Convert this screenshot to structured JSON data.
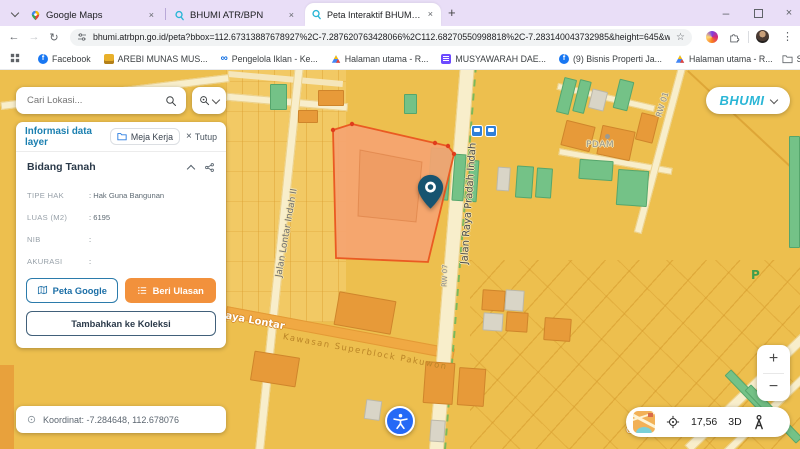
{
  "browser": {
    "tabs": [
      {
        "label": "Google Maps"
      },
      {
        "label": "BHUMI ATR/BPN"
      },
      {
        "label": "Peta Interaktif BHUMI ATR/BPN"
      }
    ],
    "url": "bhumi.atrbpn.go.id/peta?bbox=112.67313887678927%2C-7.287620763428066%2C112.68270550998818%2C-7.283140043732985&height=645&width=1366...",
    "bookmarks": {
      "items": [
        {
          "label": "Facebook"
        },
        {
          "label": "AREBI MUNAS MUS..."
        },
        {
          "label": "Pengelola Iklan - Ke..."
        },
        {
          "label": "Halaman utama - R..."
        },
        {
          "label": "MUSYAWARAH DAE..."
        },
        {
          "label": "(9) Bisnis Properti Ja..."
        },
        {
          "label": "Halaman utama - R..."
        }
      ],
      "all_label": "Semua Bookmark"
    }
  },
  "icons": {
    "back": "←",
    "forward": "→",
    "reload": "↻",
    "star": "☆",
    "kebab": "⋮",
    "new_tab": "+",
    "minimize": "–",
    "close": "×",
    "zoom_in": "+",
    "zoom_out": "−"
  },
  "map_ui": {
    "search_placeholder": "Cari Lokasi...",
    "brand": "BHUMI",
    "coordinate_bar": "Koordinat: -7.284648, 112.678076",
    "controls": {
      "zoom_level": "17,56",
      "mode_3d": "3D"
    }
  },
  "panel": {
    "title": "Informasi data layer",
    "meja_kerja": "Meja Kerja",
    "tutup": "Tutup",
    "section_title": "Bidang Tanah",
    "fields": [
      {
        "label": "TIPE HAK",
        "value": ": Hak Guna Bangunan"
      },
      {
        "label": "LUAS (M2)",
        "value": ": 6195"
      },
      {
        "label": "NIB",
        "value": ":"
      },
      {
        "label": "AKURASI",
        "value": ":"
      }
    ],
    "actions": {
      "peta_google": "Peta Google",
      "beri_ulasan": "Beri Ulasan",
      "tambah_koleksi": "Tambahkan ke Koleksi"
    }
  },
  "map": {
    "labels": {
      "street_lontar_indah": "Jalan Lontar Indah II",
      "street_pradah_indah": "Jalan Raya Pradah Indah",
      "street_raya_lontar": "Raya Lontar",
      "area_kawasan": "Kawasan Superblock Pakuwon",
      "rw01": "RW 01",
      "rw07": "RW 07",
      "pdam": "PDAM",
      "parking": "P",
      "carsentro": "Carsentro",
      "street_fragment": "nose"
    }
  },
  "colors": {
    "brand_teal": "#2ab6d6",
    "accent_orange": "#f2913c",
    "panel_title_blue": "#1a7fb0",
    "selected_parcel_fill": "#f5a471",
    "selected_parcel_border": "#ea5a22",
    "map_base": "#edbf4e",
    "a11y_blue": "#2469f6",
    "pin_navy": "#175470"
  }
}
